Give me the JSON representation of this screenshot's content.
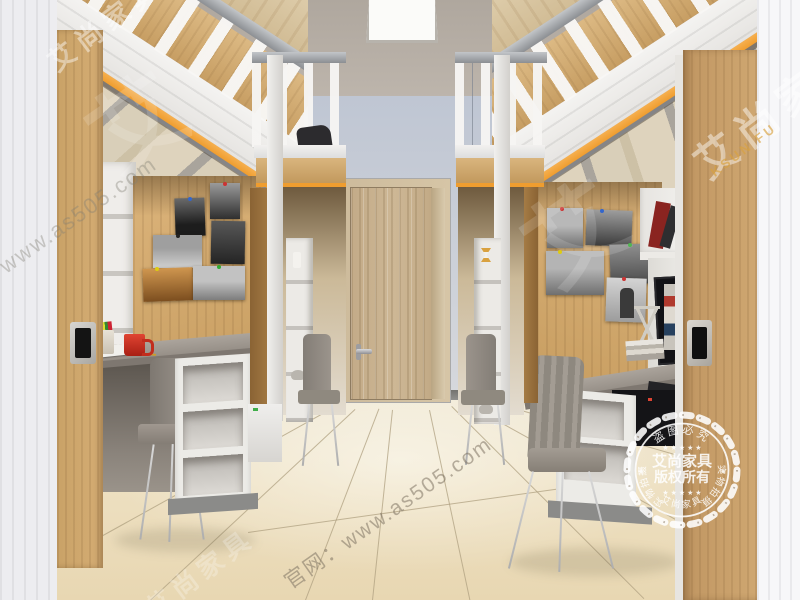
{
  "scene": {
    "subject": "dormitory room with two rows of loft beds over desks, wardrobes, shelves, gray chairs and a wooden door"
  },
  "watermark": {
    "brand": "艾尚家具",
    "brand_latin_partial": "KSUN FU",
    "website": "官网：www.as505.com",
    "big_glyph": "艾"
  },
  "stamp": {
    "top_arc": "盗图必究",
    "left_arc": "实物拍摄",
    "right_arc": "实物拍摄",
    "bottom_arc": "艾尚家具",
    "center_line1": "艾尚家具",
    "center_line2": "版权所有",
    "star": "★",
    "stars_row": "★ ★ ★ ★ ★"
  },
  "colors": {
    "accent_orange_trim": "#ef9d2f",
    "wood_light": "#d5ad74",
    "wall_blue_gray": "#c6ccd7",
    "floor_cream": "#eddfc0",
    "furniture_white": "#eceae6",
    "chair_gray": "#8e887f",
    "mug_red": "#c22d1d"
  }
}
